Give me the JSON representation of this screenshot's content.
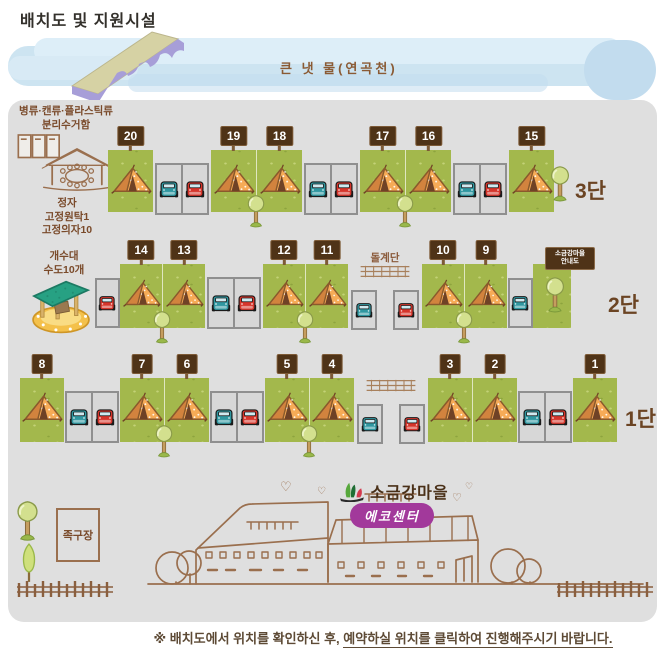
{
  "title": "배치도 및 지원시설",
  "river": {
    "label": "큰 냇 물(연곡천)"
  },
  "facilities": {
    "recycle_line1": "병류·캔류·플라스틱류",
    "recycle_line2": "분리수거함",
    "pavilion_line1": "정자",
    "pavilion_line2": "고정원탁1",
    "pavilion_line3": "고정의자10",
    "sink_line1": "개수대",
    "sink_line2": "수도10개",
    "jokgu": "족구장"
  },
  "map": {
    "tiers": [
      {
        "label": "3단",
        "end_tree": true,
        "segments": [
          {
            "type": "tent",
            "site": "20"
          },
          {
            "type": "parking",
            "cars": [
              "teal",
              "red"
            ]
          },
          {
            "type": "tent",
            "site": "19",
            "tree": true
          },
          {
            "type": "tent",
            "site": "18"
          },
          {
            "type": "parking",
            "cars": [
              "teal",
              "red"
            ]
          },
          {
            "type": "tent",
            "site": "17",
            "tree": true
          },
          {
            "type": "tent",
            "site": "16"
          },
          {
            "type": "parking",
            "cars": [
              "teal",
              "red"
            ]
          },
          {
            "type": "tent",
            "site": "15"
          }
        ]
      },
      {
        "label": "2단",
        "notice_line1": "소금강마을",
        "notice_line2": "안내도",
        "segments": [
          {
            "type": "parking1",
            "cars": [
              "red"
            ]
          },
          {
            "type": "tent",
            "site": "14",
            "tree": true
          },
          {
            "type": "tent",
            "site": "13"
          },
          {
            "type": "parking",
            "cars": [
              "teal",
              "red"
            ]
          },
          {
            "type": "tent",
            "site": "12",
            "tree": true
          },
          {
            "type": "tent",
            "site": "11"
          },
          {
            "type": "gap",
            "stairs_label": "돌계단",
            "parkings": [
              "teal",
              "red"
            ]
          },
          {
            "type": "tent",
            "site": "10",
            "tree": true
          },
          {
            "type": "tent",
            "site": "9"
          },
          {
            "type": "parking1",
            "cars": [
              "teal"
            ]
          },
          {
            "type": "green",
            "tree": true
          }
        ]
      },
      {
        "label": "1단",
        "segments": [
          {
            "type": "tent",
            "site": "8"
          },
          {
            "type": "parking",
            "cars": [
              "teal",
              "red"
            ]
          },
          {
            "type": "tent",
            "site": "7",
            "tree": true
          },
          {
            "type": "tent",
            "site": "6"
          },
          {
            "type": "parking",
            "cars": [
              "teal",
              "red"
            ]
          },
          {
            "type": "tent",
            "site": "5",
            "tree": true
          },
          {
            "type": "tent",
            "site": "4"
          },
          {
            "type": "gap",
            "parkings": [
              "teal",
              "red"
            ]
          },
          {
            "type": "tent",
            "site": "3"
          },
          {
            "type": "tent",
            "site": "2"
          },
          {
            "type": "parking",
            "cars": [
              "teal",
              "red"
            ]
          },
          {
            "type": "tent",
            "site": "1"
          }
        ]
      }
    ]
  },
  "logo": {
    "village": "소금강마을",
    "center": "에코센터"
  },
  "footer": {
    "prefix": "※ 배치도에서 위치를 확인하신 후, ",
    "underlined": "예약하실 위치를 클릭하여 진행해주시기 바랍니다."
  },
  "colors": {
    "panel": "#dfdfdf",
    "grass": "#a3b84c",
    "tent": "#f6ab57",
    "sign": "#4f3317",
    "car_teal": "#2f97a0",
    "car_red": "#d6352b",
    "badge": "#a2399b",
    "river": "#cde4f1",
    "label_brown": "#6b4423"
  }
}
